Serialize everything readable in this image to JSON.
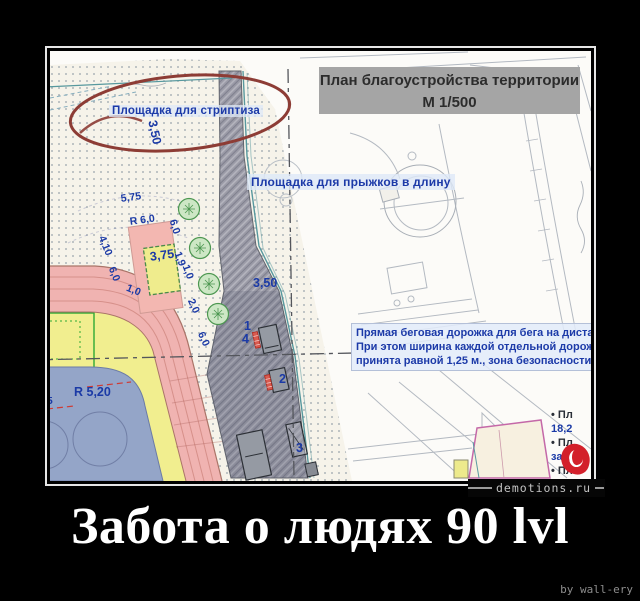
{
  "caption": {
    "title": "Забота о людях 90 lvl",
    "credit": "by wall-ery"
  },
  "watermark": "demotions.ru",
  "plan": {
    "title1": "План благоустройства территории",
    "title2": "М 1/500",
    "striptiz_label": "Площадка для стриптиза",
    "jump_label": "Площадка для прыжков в длину",
    "note_lines": [
      "Прямая беговая дорожка для бега на диста",
      "При этом ширина каждой отдельной дорож",
      "принята равной 1,25 м., зона безопасности"
    ],
    "legend_lines": [
      {
        "t": "• Пл",
        "c": "dark"
      },
      {
        "t": "18,2",
        "c": "blue"
      },
      {
        "t": "• Пл",
        "c": "dark"
      },
      {
        "t": "зам",
        "c": "blue"
      },
      {
        "t": "• Пл",
        "c": "dark"
      }
    ],
    "dimensions": [
      {
        "t": "5,75",
        "x": 70,
        "y": 142,
        "r": -8
      },
      {
        "t": "R 6,0",
        "x": 79,
        "y": 165,
        "r": -8
      },
      {
        "t": "4,10",
        "x": 57,
        "y": 183,
        "r": 68
      },
      {
        "t": "6,0",
        "x": 67,
        "y": 214,
        "r": 68
      },
      {
        "t": "1,0",
        "x": 79,
        "y": 231,
        "r": 22
      },
      {
        "t": "3,75",
        "x": 99,
        "y": 199,
        "r": -8,
        "big": true
      },
      {
        "t": "6,0",
        "x": 128,
        "y": 167,
        "r": 72
      },
      {
        "t": "1,9",
        "x": 133,
        "y": 199,
        "r": 70
      },
      {
        "t": "1,0",
        "x": 141,
        "y": 212,
        "r": 70
      },
      {
        "t": "2,0",
        "x": 146,
        "y": 246,
        "r": 66
      },
      {
        "t": "6,0",
        "x": 156,
        "y": 279,
        "r": 66
      },
      {
        "t": "3,50",
        "x": 109,
        "y": 68,
        "r": 78,
        "big": true
      },
      {
        "t": "3,50",
        "x": 203,
        "y": 225,
        "r": 0,
        "big": true
      },
      {
        "t": "R 5,20",
        "x": 24,
        "y": 334,
        "r": 0,
        "big": true
      },
      {
        "t": "85",
        "x": -9,
        "y": 344,
        "r": 0
      },
      {
        "t": "0",
        "x": -9,
        "y": 359,
        "r": 0
      },
      {
        "t": "1",
        "x": 194,
        "y": 268,
        "r": 0,
        "big": true
      },
      {
        "t": "4",
        "x": 192,
        "y": 281,
        "r": 0,
        "big": true
      },
      {
        "t": "2",
        "x": 229,
        "y": 321,
        "r": 0,
        "big": true
      },
      {
        "t": "3",
        "x": 246,
        "y": 390,
        "r": 0,
        "big": true
      }
    ],
    "colors": {
      "track_pink": "#f0b3b1",
      "infield_yellow": "#f1ee8f",
      "court_blue": "#94a5c8",
      "walkway_grey": "#9a9aa6",
      "annotation_red": "#8d3c35",
      "label_blue": "#1c3aa8",
      "logo_red": "#d3202a"
    }
  }
}
